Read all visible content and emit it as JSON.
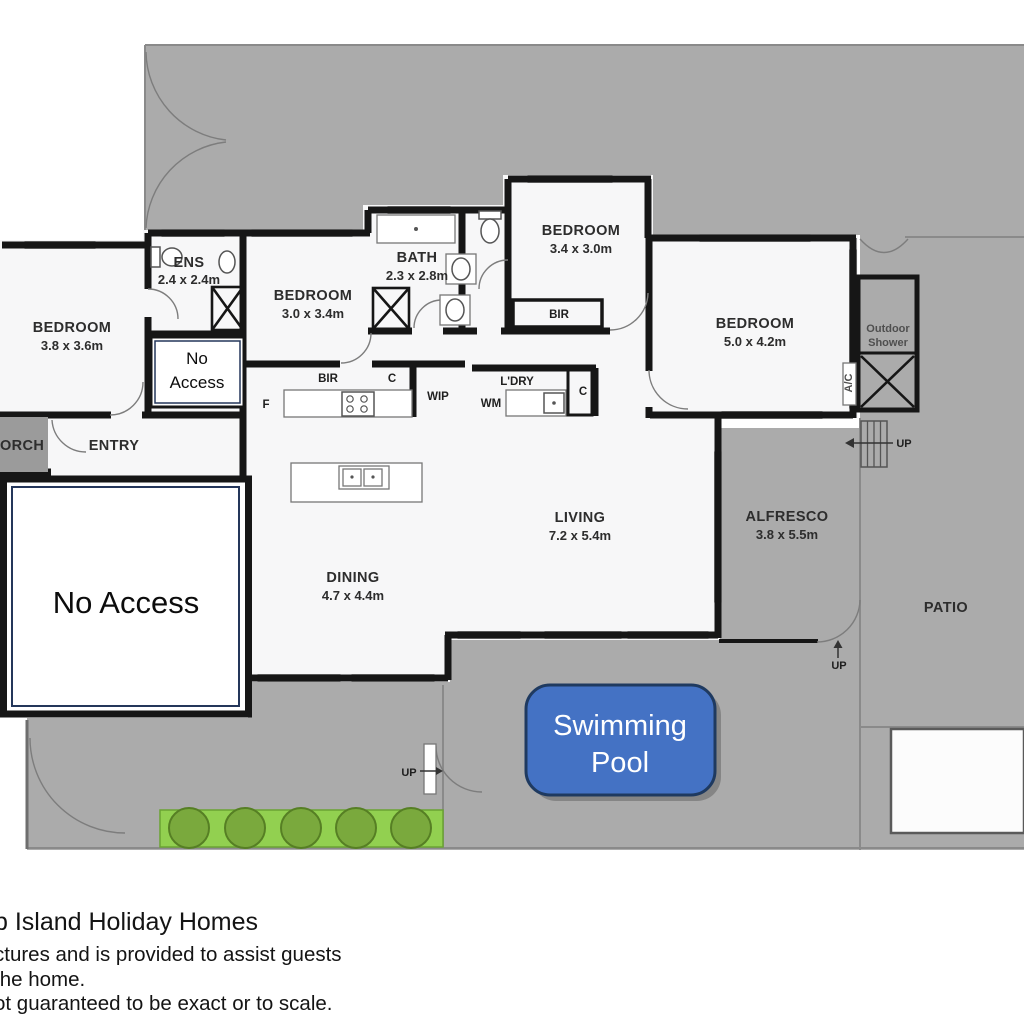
{
  "colors": {
    "outdoor": "#ababab",
    "porch": "#9b9b9b",
    "wall": "#161616",
    "pool_fill": "#4472c4",
    "pool_border": "#1f3a60",
    "garden_bed": "#92d050",
    "garden_bush": "#7aa93d",
    "no_access_border": "#24365a"
  },
  "rooms": {
    "bedroom_left": {
      "name": "BEDROOM",
      "dims": "3.8 x 3.6m"
    },
    "ensuite": {
      "name": "ENS",
      "dims": "2.4 x 2.4m"
    },
    "bedroom_mid": {
      "name": "BEDROOM",
      "dims": "3.0 x 3.4m"
    },
    "bath": {
      "name": "BATH",
      "dims": "2.3 x 2.8m"
    },
    "bedroom_top": {
      "name": "BEDROOM",
      "dims": "3.4 x 3.0m"
    },
    "bedroom_right": {
      "name": "BEDROOM",
      "dims": "5.0 x 4.2m"
    },
    "living": {
      "name": "LIVING",
      "dims": "7.2 x 5.4m"
    },
    "dining": {
      "name": "DINING",
      "dims": "4.7 x 4.4m"
    },
    "alfresco": {
      "name": "ALFRESCO",
      "dims": "3.8 x 5.5m"
    },
    "patio": {
      "name": "PATIO"
    },
    "entry": {
      "name": "ENTRY"
    },
    "porch": {
      "name": "ORCH"
    },
    "sauna": {
      "name": "SAUNA"
    },
    "outdoor_shower": {
      "line1": "Outdoor",
      "line2": "Shower"
    }
  },
  "features": {
    "bir_hall": "BIR",
    "bir_bedroom_top": "BIR",
    "closet_hall": "C",
    "closet_laundry": "C",
    "fridge": "F",
    "wip": "WIP",
    "wm": "WM",
    "laundry": "L'DRY",
    "ac": "A/C",
    "up_stairs": "UP",
    "up_alfresco": "UP",
    "up_pool": "UP"
  },
  "annotations": {
    "no_access_small": {
      "line1": "No",
      "line2": "Access"
    },
    "no_access_large": "No Access",
    "pool": {
      "line1": "Swimming",
      "line2": "Pool"
    }
  },
  "footer": {
    "title": "p Island Holiday Homes",
    "line1": "ctures and is provided to assist guests",
    "line2": "the home.",
    "line3": "ot guaranteed to be exact or to scale."
  }
}
